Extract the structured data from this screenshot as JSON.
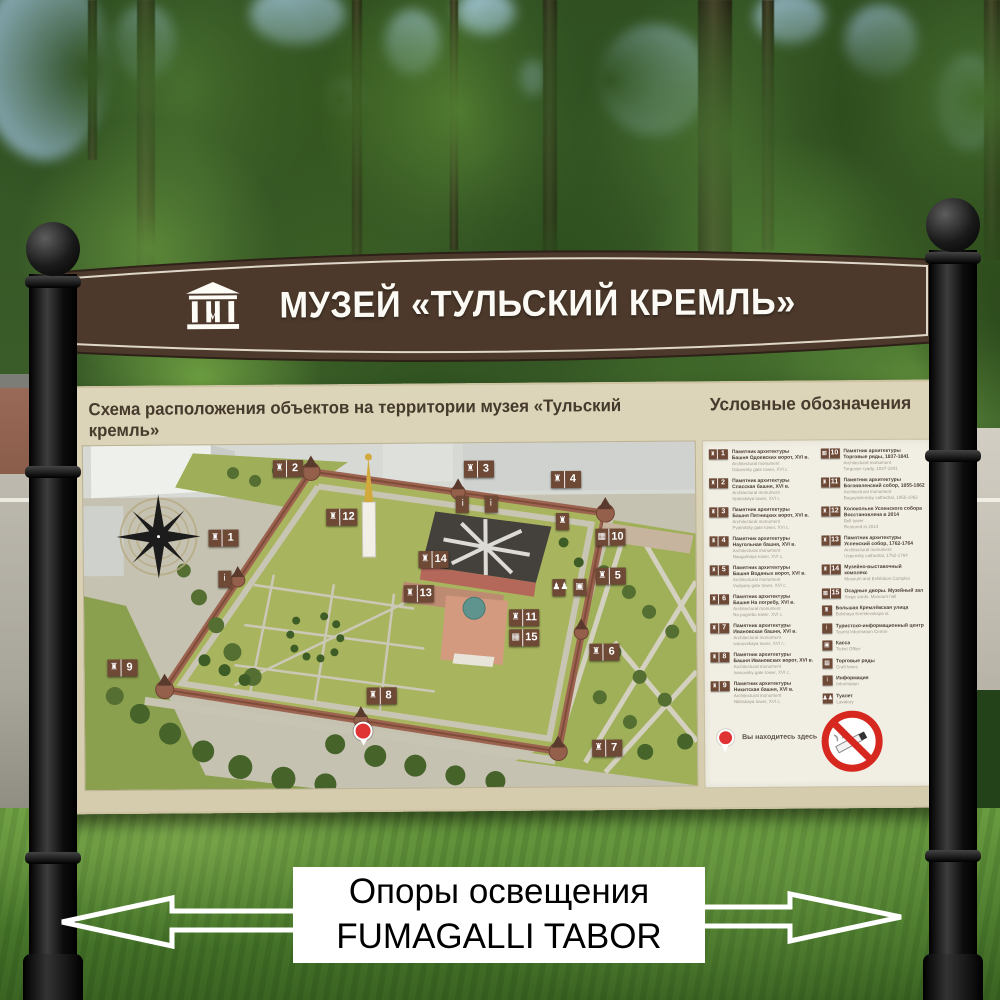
{
  "header": {
    "title": "МУЗЕЙ «ТУЛЬСКИЙ КРЕМЛЬ»",
    "logo_letter": "М"
  },
  "board": {
    "map_title": "Схема расположения объектов на территории музея «Тульский кремль»",
    "legend_title": "Условные обозначения"
  },
  "map": {
    "markers": [
      {
        "n": "1",
        "icon": "tower",
        "x": 22.9,
        "y": 27.0
      },
      {
        "n": "2",
        "icon": "tower",
        "x": 33.5,
        "y": 7.0
      },
      {
        "n": "3",
        "icon": "tower",
        "x": 64.7,
        "y": 7.6
      },
      {
        "n": "4",
        "icon": "tower",
        "x": 78.9,
        "y": 10.8
      },
      {
        "n": "5",
        "icon": "tower",
        "x": 86.1,
        "y": 39.0
      },
      {
        "n": "6",
        "icon": "tower",
        "x": 85.0,
        "y": 61.0
      },
      {
        "n": "7",
        "icon": "tower",
        "x": 85.3,
        "y": 89.0
      },
      {
        "n": "8",
        "icon": "tower",
        "x": 48.5,
        "y": 73.3
      },
      {
        "n": "9",
        "icon": "tower",
        "x": 6.2,
        "y": 64.5
      },
      {
        "n": "10",
        "icon": "trade-rows",
        "x": 86.1,
        "y": 27.6
      },
      {
        "n": "11",
        "icon": "cathedral",
        "x": 71.9,
        "y": 50.9
      },
      {
        "n": "12",
        "icon": "bell-tower",
        "x": 42.2,
        "y": 21.2
      },
      {
        "n": "13",
        "icon": "bell-tower",
        "x": 54.7,
        "y": 43.6
      },
      {
        "n": "14",
        "icon": "museum",
        "x": 57.2,
        "y": 33.7
      },
      {
        "n": "15",
        "icon": "siege-yards",
        "x": 71.9,
        "y": 56.7
      },
      {
        "icon": "information",
        "x": 23.0,
        "y": 39.0
      },
      {
        "icon": "information",
        "x": 62.0,
        "y": 17.7
      },
      {
        "icon": "tourist-info",
        "x": 66.6,
        "y": 17.7
      },
      {
        "icon": "street",
        "x": 78.3,
        "y": 23.0
      },
      {
        "icon": "lavatory",
        "x": 77.6,
        "y": 42.2
      },
      {
        "icon": "ticket-office",
        "x": 81.0,
        "y": 42.2
      },
      {
        "type": "you-are-here",
        "x": 45.4,
        "y": 83.4
      }
    ]
  },
  "legend": {
    "columns": [
      [
        {
          "num": "1",
          "icon": "tower",
          "ru": [
            "Памятник архитектуры",
            "Башня Одоевских ворот, XVI в."
          ],
          "en": [
            "Architectural monument",
            "Odoevsky gate tower, XVI c."
          ]
        },
        {
          "num": "2",
          "icon": "tower",
          "ru": [
            "Памятник архитектуры",
            "Спасская башня, XVI в."
          ],
          "en": [
            "Architectural monument",
            "Spasskaya tower, XVI c."
          ]
        },
        {
          "num": "3",
          "icon": "tower",
          "ru": [
            "Памятник архитектуры",
            "Башня Пятницких ворот, XVI в."
          ],
          "en": [
            "Architectural monument",
            "Pyatnitsky gate tower, XVI c."
          ]
        },
        {
          "num": "4",
          "icon": "tower",
          "ru": [
            "Памятник архитектуры",
            "Наугольная башня, XVI в."
          ],
          "en": [
            "Architectural monument",
            "Naugolnaya tower, XVI c."
          ]
        },
        {
          "num": "5",
          "icon": "tower",
          "ru": [
            "Памятник архитектуры",
            "Башня Водяных ворот, XVI в."
          ],
          "en": [
            "Architectural monument",
            "Vodyany gate tower, XVI c."
          ]
        },
        {
          "num": "6",
          "icon": "tower",
          "ru": [
            "Памятник архитектуры",
            "Башня На погребу, XVI в."
          ],
          "en": [
            "Architectural monument",
            "Na pogrebu tower, XVI c."
          ]
        },
        {
          "num": "7",
          "icon": "tower",
          "ru": [
            "Памятник архитектуры",
            "Ивановская башня, XVI в."
          ],
          "en": [
            "Architectural monument",
            "Ivanovskaya tower, XVI c."
          ]
        },
        {
          "num": "8",
          "icon": "tower",
          "ru": [
            "Памятник архитектуры",
            "Башня Ивановских ворот, XVI в."
          ],
          "en": [
            "Architectural monument",
            "Ivanovsky gate tower, XVI c."
          ]
        },
        {
          "num": "9",
          "icon": "tower",
          "ru": [
            "Памятник архитектуры",
            "Никитская башня, XVI в."
          ],
          "en": [
            "Architectural monument",
            "Nikitskaya tower, XVI c."
          ]
        }
      ],
      [
        {
          "num": "10",
          "icon": "trade-rows",
          "ru": [
            "Памятник архитектуры",
            "Торговые ряды, 1837-1841"
          ],
          "en": [
            "Architectural monument",
            "Torgovye ryady, 1837-1841"
          ]
        },
        {
          "num": "11",
          "icon": "cathedral",
          "ru": [
            "Памятник архитектуры",
            "Богоявленский собор, 1855-1862"
          ],
          "en": [
            "Architectural monument",
            "Bogoyavlensky cathedral, 1855-1862"
          ]
        },
        {
          "num": "12",
          "icon": "bell-tower",
          "ru": [
            "Колокольня Успенского собора",
            "Восстановлена в 2014"
          ],
          "en": [
            "Bell tower",
            "Restored in 2014"
          ]
        },
        {
          "num": "13",
          "icon": "cathedral",
          "ru": [
            "Памятник архитектуры",
            "Успенский собор, 1762-1764"
          ],
          "en": [
            "Architectural monument",
            "Uspensky cathedral, 1762-1764"
          ]
        },
        {
          "num": "14",
          "icon": "museum",
          "ru": [
            "Музейно-выставочный комплекс"
          ],
          "en": [
            "Museum and Exhibition Complex"
          ]
        },
        {
          "num": "15",
          "icon": "siege-yards",
          "ru": [
            "Осадные дворы. Музейный зал"
          ],
          "en": [
            "Siege yards. Museum hall"
          ]
        },
        {
          "icon": "street",
          "ru": [
            "Большая Кремлёвская улица"
          ],
          "en": [
            "Bolshaya Kremlevskaya st."
          ]
        },
        {
          "icon": "tourist-info",
          "ru": [
            "Туристско-информационный центр"
          ],
          "en": [
            "Tourist Information Centre"
          ]
        },
        {
          "icon": "ticket-office",
          "ru": [
            "Касса"
          ],
          "en": [
            "Ticket Office"
          ]
        },
        {
          "icon": "craft-rows",
          "ru": [
            "Торговые ряды"
          ],
          "en": [
            "Craft lanes"
          ]
        },
        {
          "icon": "information",
          "ru": [
            "Информация"
          ],
          "en": [
            "Information"
          ]
        },
        {
          "icon": "lavatory",
          "ru": [
            "Туалет"
          ],
          "en": [
            "Lavatory"
          ]
        }
      ]
    ],
    "you_are_here": "Вы находитесь здесь"
  },
  "footer": {
    "line1": "Опоры освещения",
    "line2": "FUMAGALLI TABOR"
  },
  "colors": {
    "sign_brown": "#4c392b",
    "board_tan": "#d8cfb2",
    "legend_bg": "#f1eee3",
    "plaque_brown": "#6d4936",
    "kremlin_wall": "#9c6450",
    "accent_red": "#d6281e",
    "pin_red": "#e03434"
  }
}
